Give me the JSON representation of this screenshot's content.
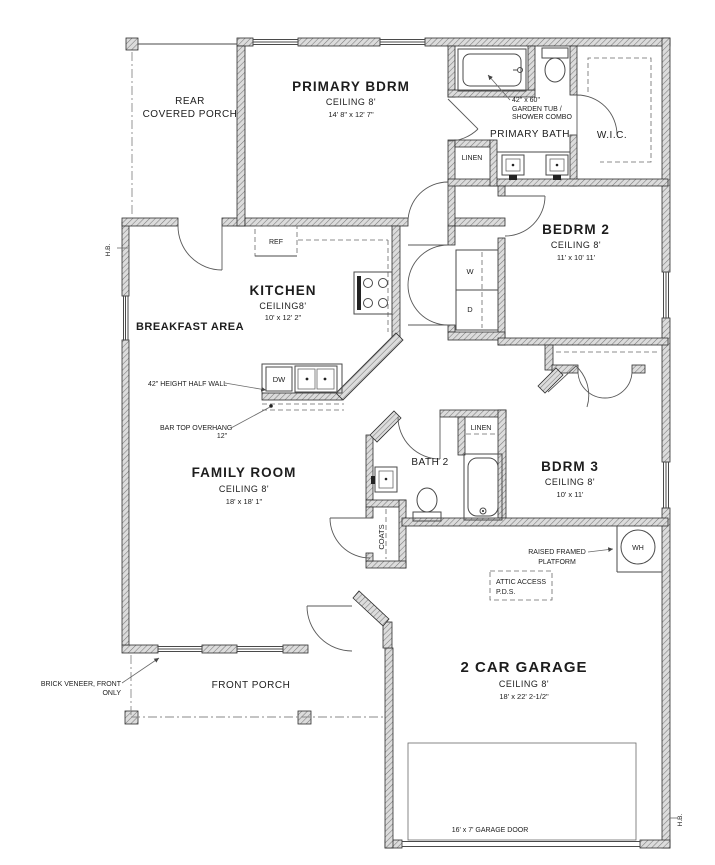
{
  "colors": {
    "ink": "#2e2e2e",
    "wall_fill": "#dcdcdc",
    "wall_hatch": "#7a7a7a",
    "paper": "#ffffff"
  },
  "rooms": {
    "rear_porch": {
      "line1": "REAR",
      "line2": "COVERED PORCH"
    },
    "primary_bdrm": {
      "name": "PRIMARY BDRM",
      "ceiling": "CEILING 8'",
      "dims": "14' 8\" x 12' 7\""
    },
    "primary_bath": {
      "name": "PRIMARY BATH"
    },
    "wic": {
      "name": "W.I.C."
    },
    "linen_primary": {
      "name": "LINEN"
    },
    "bedrm2": {
      "name": "BEDRM 2",
      "ceiling": "CEILING 8'",
      "dims": "11' x 10' 11'"
    },
    "kitchen": {
      "name": "KITCHEN",
      "ceiling": "CEILING8'",
      "dims": "10' x 12' 2\""
    },
    "breakfast": {
      "name": "BREAKFAST AREA"
    },
    "family": {
      "name": "FAMILY ROOM",
      "ceiling": "CEILING 8'",
      "dims": "18' x 18' 1\""
    },
    "bath2": {
      "name": "BATH 2"
    },
    "linen_hall": {
      "name": "LINEN"
    },
    "bedrm3": {
      "name": "BDRM 3",
      "ceiling": "CEILING 8'",
      "dims": "10' x 11'"
    },
    "coats": {
      "name": "COATS"
    },
    "garage": {
      "name": "2 CAR GARAGE",
      "ceiling": "CEILING 8'",
      "dims": "18' x 22' 2-1/2\""
    },
    "front_porch": {
      "name": "FRONT PORCH"
    }
  },
  "fixtures": {
    "ref": "REF",
    "dw": "DW",
    "washer": "W",
    "dryer": "D",
    "wh": "WH"
  },
  "annotations": {
    "garden_tub": {
      "line1": "42\" x 60\"",
      "line2": "GARDEN TUB /",
      "line3": "SHOWER COMBO"
    },
    "half_wall": "42\" HEIGHT HALF WALL",
    "bar_top": {
      "line1": "BAR TOP OVERHANG",
      "line2": "12\""
    },
    "raised_platform": {
      "line1": "RAISED FRAMED",
      "line2": "PLATFORM"
    },
    "attic": {
      "line1": "ATTIC ACCESS",
      "line2": "P.D.S."
    },
    "brick": {
      "line1": "BRICK VENEER, FRONT",
      "line2": "ONLY"
    },
    "garage_door": "16' x 7' GARAGE DOOR",
    "hb_left": "H.B.",
    "hb_right": "H.B."
  }
}
